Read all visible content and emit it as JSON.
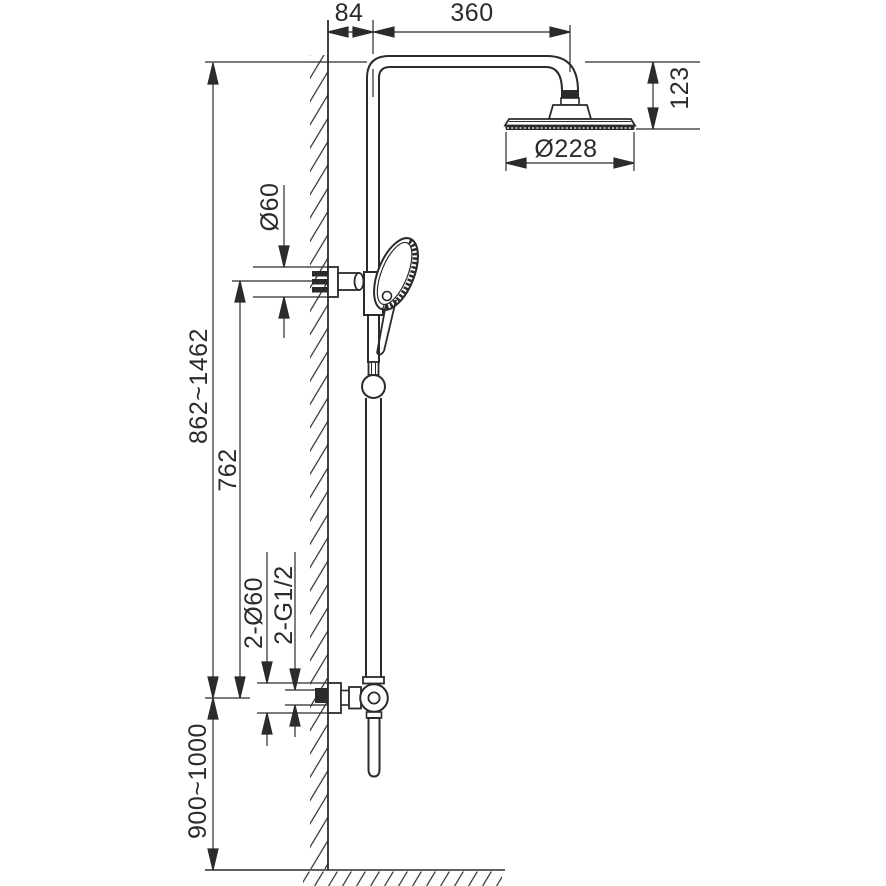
{
  "drawing": {
    "kind": "shower-column-installation-dimension-drawing",
    "colors": {
      "line": "#2b2b2b",
      "background": "#ffffff"
    },
    "dims": {
      "wall_offset": "84",
      "arm_length": "360",
      "head_drop": "123",
      "head_diameter": "Ø228",
      "holder_diameter": "Ø60",
      "column_range": "862~1462",
      "holder_height": "762",
      "escutcheon": "2-Ø60",
      "thread": "2-G1/2",
      "mixer_height": "900~1000"
    },
    "components": [
      "wall-section",
      "floor-section",
      "riser-pipe",
      "shower-arm",
      "overhead-shower-head",
      "hand-shower",
      "wall-bracket",
      "slider-knob",
      "mixer-valve",
      "lever-handle"
    ]
  }
}
